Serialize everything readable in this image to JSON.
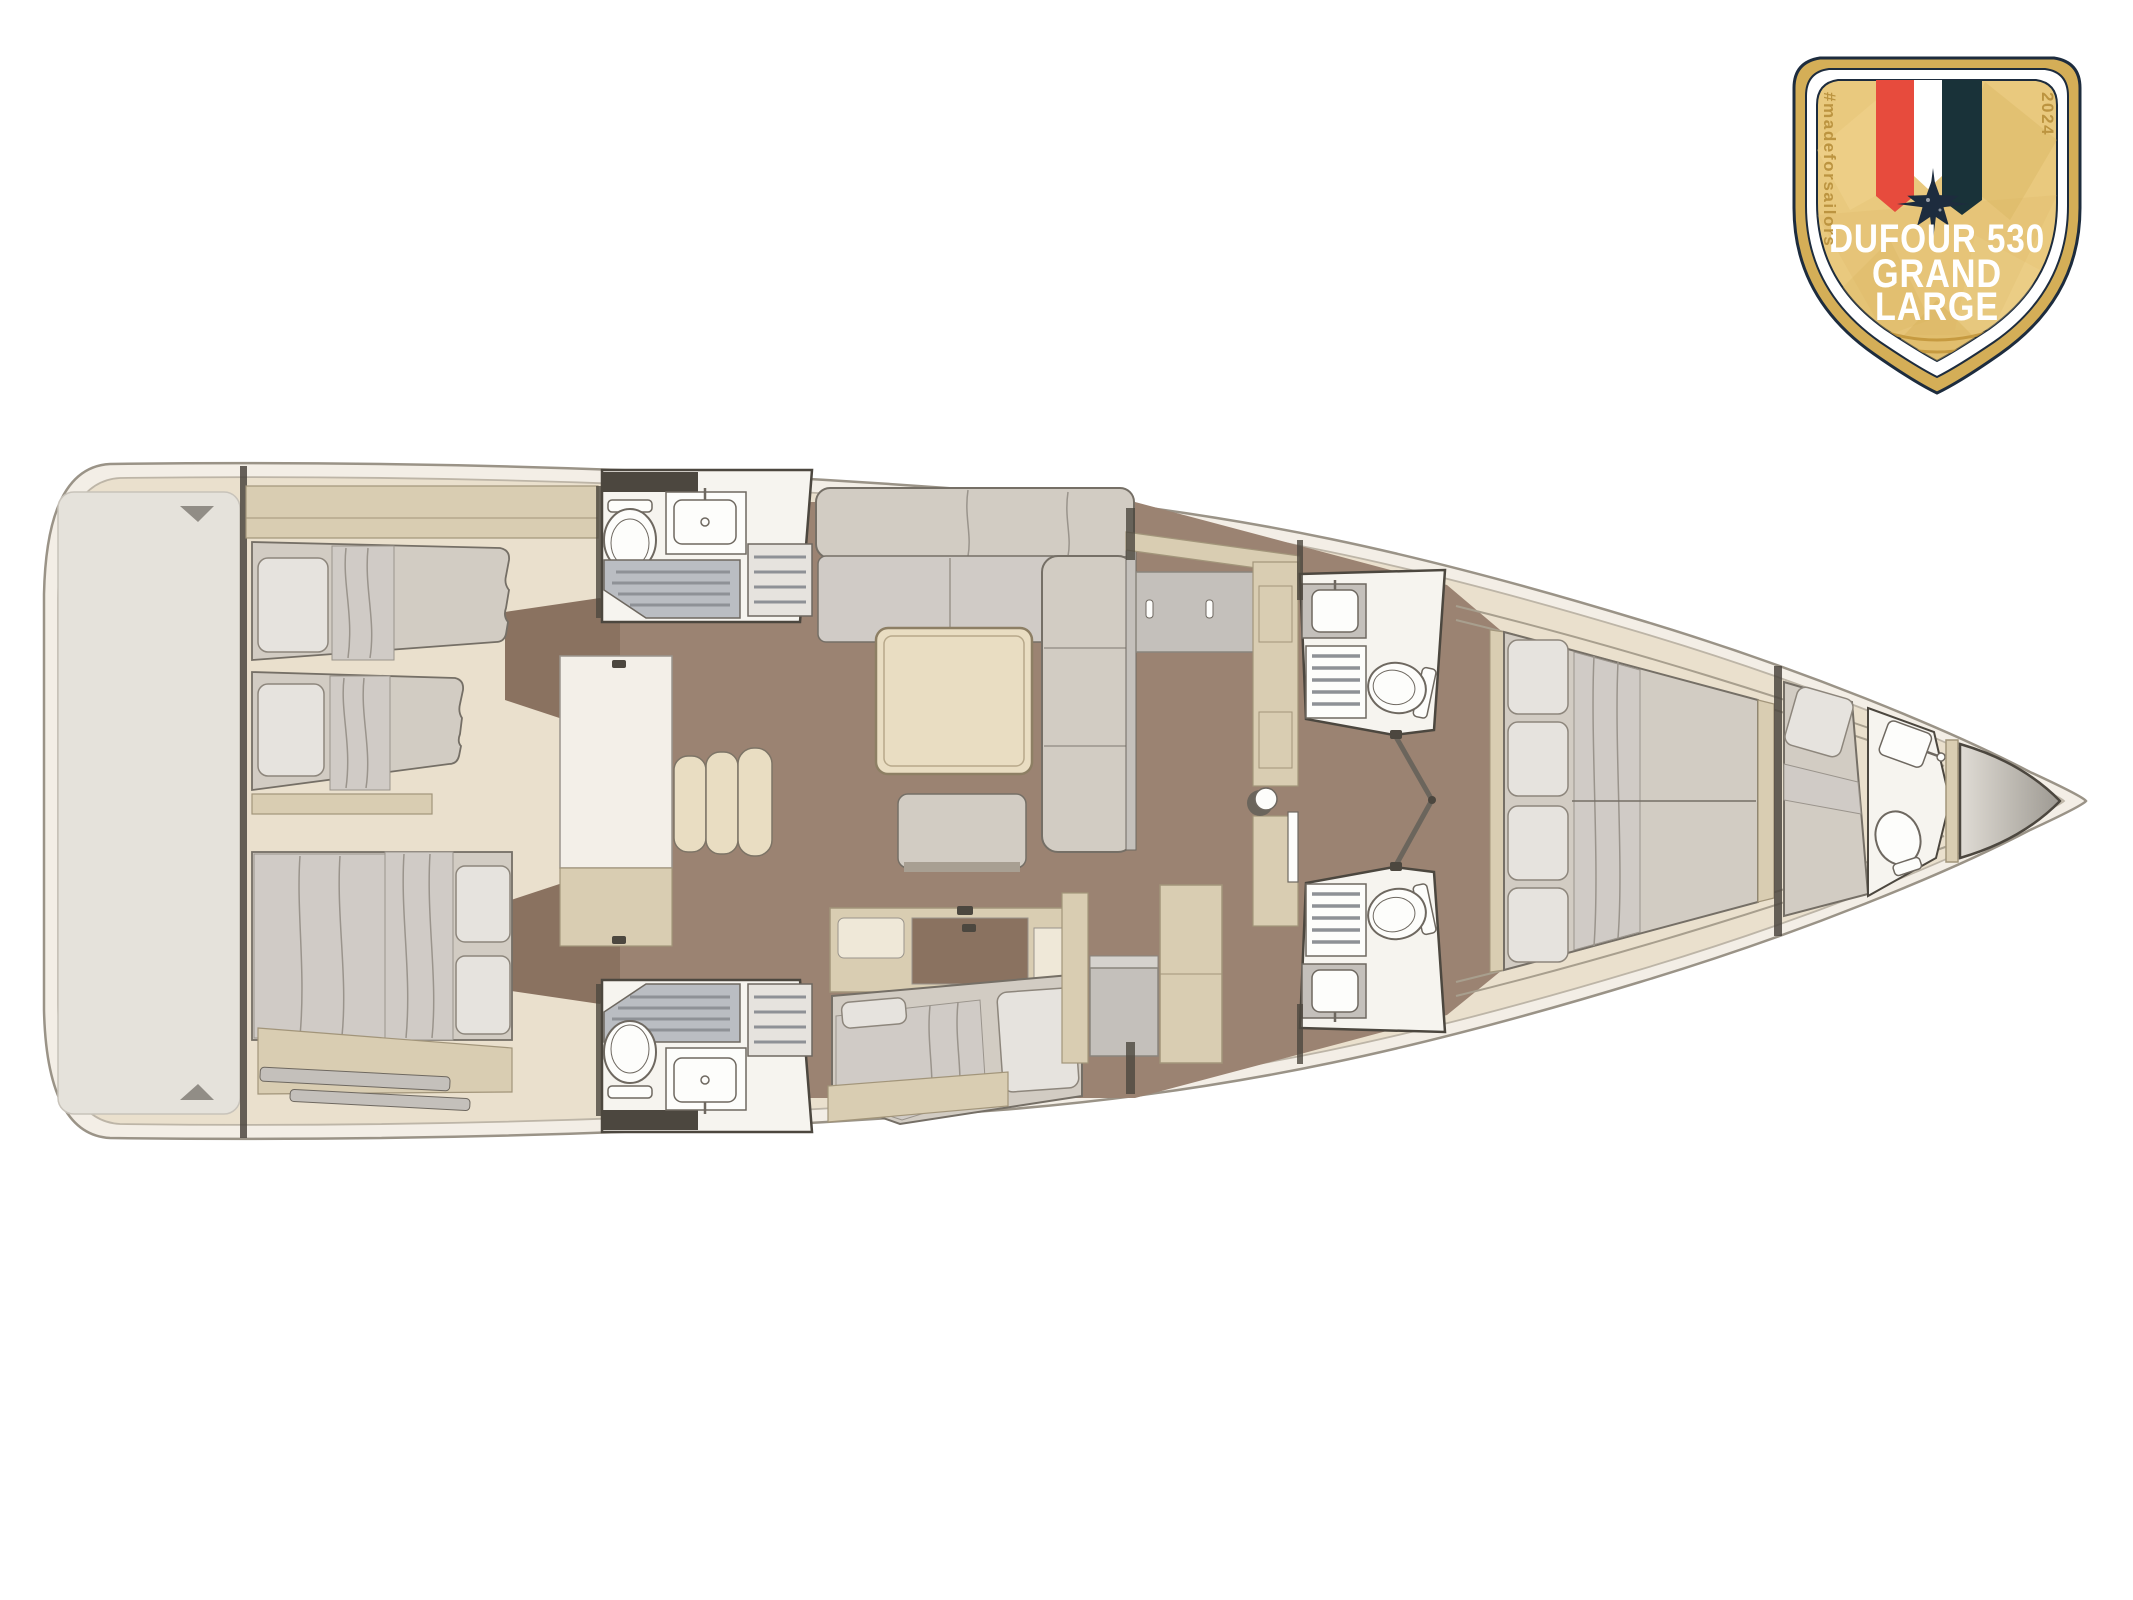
{
  "badge": {
    "line1": "DUFOUR 530",
    "line2": "GRAND",
    "line3": "LARGE",
    "hashtag": "#madeforsailors",
    "year": "2024"
  },
  "palette": {
    "page_bg": "#ffffff",
    "hull_fill": "#f3eee6",
    "hull_stroke": "#9a9387",
    "deck_fill": "#eae0cd",
    "deck_line": "#bdb5a7",
    "transom_fill": "#e5e2db",
    "transom_stroke": "#c8c3ba",
    "sole_wood": "#9b8372",
    "wood_accent": "#8a7260",
    "cabinet": "#d9cdb2",
    "cabinet_stroke": "#a2957a",
    "gray_cab": "#c4c0bb",
    "panel_cream": "#efe8d8",
    "mattress": "#d2ccc3",
    "mattress_stroke": "#756f66",
    "pillow": "#e6e3de",
    "pillow_stroke": "#8d867c",
    "blanket": "#d0cbc6",
    "fold_stroke": "#9a948c",
    "bath_floor": "#f6f4ef",
    "fixture": "#fdfdfb",
    "fixture_stroke": "#6e6860",
    "tray": "#babdc2",
    "slat": "#8e9196",
    "wall": "#4c473f",
    "engine_box": "#f3efe8",
    "step": "#e9ddc2",
    "step_stroke": "#7d7466",
    "locker_light": "#e0dcd5",
    "locker_dark": "#9d9992",
    "badge_border_gold": "#d4ae57",
    "badge_navy": "#1d2c3e",
    "badge_white": "#ffffff",
    "badge_gold": "#e9c97e",
    "badge_facet_light": "#f2d794",
    "badge_facet_dark": "#d8b25c",
    "badge_swoosh": "#c19438",
    "badge_red": "#e74b3d",
    "badge_teal": "#193239",
    "badge_text_gold": "#bc9440"
  }
}
